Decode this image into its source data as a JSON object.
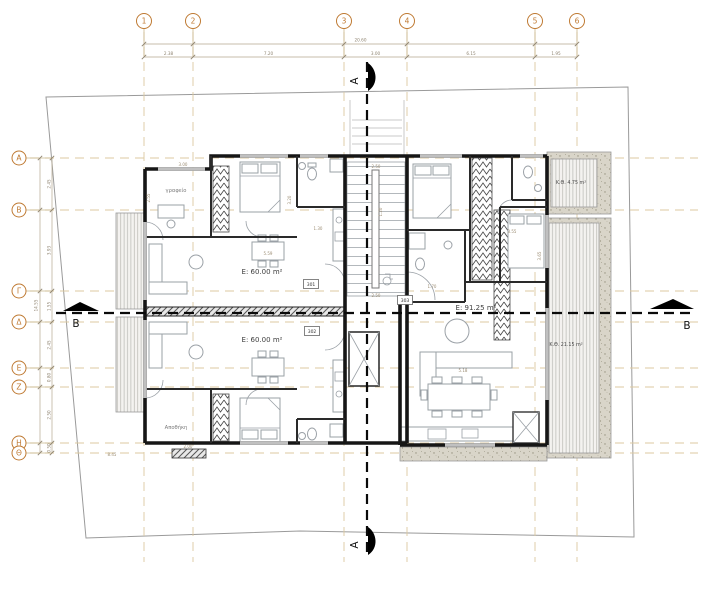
{
  "colors": {
    "grid_dash": "#dcc9a0",
    "bubble_stroke": "#bf7a33",
    "wall": "#161616",
    "dimension": "#8f8471",
    "furniture": "#9aa0a6",
    "section": "#0a0a0a",
    "boundary": "#9a9a9a",
    "deck_hatch": "#b7b7b2",
    "concrete": "#d9d5c9"
  },
  "grid": {
    "columns": [
      {
        "label": "1",
        "x": 144
      },
      {
        "label": "2",
        "x": 193
      },
      {
        "label": "3",
        "x": 344
      },
      {
        "label": "4",
        "x": 407
      },
      {
        "label": "5",
        "x": 535
      },
      {
        "label": "6",
        "x": 577
      }
    ],
    "rows": [
      {
        "label": "A",
        "y": 158
      },
      {
        "label": "B",
        "y": 210
      },
      {
        "label": "Γ",
        "y": 291
      },
      {
        "label": "Δ",
        "y": 322
      },
      {
        "label": "E",
        "y": 368
      },
      {
        "label": "Z",
        "y": 387
      },
      {
        "label": "H",
        "y": 443
      },
      {
        "label": "Θ",
        "y": 453
      }
    ]
  },
  "dimensions": {
    "top_total": "20.60",
    "top_segments": [
      "2.38",
      "7.20",
      "3.00",
      "6.15",
      "1.95"
    ],
    "left_total": "14.55",
    "left_segments": [
      "2.45",
      "3.93",
      "1.55",
      "2.45",
      "0.80",
      "2.50",
      "0.50"
    ],
    "inline": [
      {
        "v": "3.00",
        "x": 183,
        "y": 166,
        "r": 0
      },
      {
        "v": "2.55",
        "x": 150,
        "y": 198,
        "r": -90
      },
      {
        "v": "3.20",
        "x": 291,
        "y": 200,
        "r": -90
      },
      {
        "v": "1.30",
        "x": 318,
        "y": 230,
        "r": 0
      },
      {
        "v": "5.59",
        "x": 268,
        "y": 255,
        "r": 0
      },
      {
        "v": "2.50",
        "x": 376,
        "y": 168,
        "r": 0
      },
      {
        "v": "1.20",
        "x": 382,
        "y": 212,
        "r": -90
      },
      {
        "v": "2.50",
        "x": 376,
        "y": 297,
        "r": 0
      },
      {
        "v": "3.55",
        "x": 512,
        "y": 233,
        "r": 0
      },
      {
        "v": "3.65",
        "x": 541,
        "y": 256,
        "r": -90
      },
      {
        "v": "1.70",
        "x": 432,
        "y": 288,
        "r": 0
      },
      {
        "v": "5.18",
        "x": 463,
        "y": 372,
        "r": 0
      },
      {
        "v": "2.00",
        "x": 188,
        "y": 448,
        "r": 0
      },
      {
        "v": "8.45",
        "x": 112,
        "y": 456,
        "r": 0
      }
    ]
  },
  "sections": {
    "a": {
      "label": "A"
    },
    "b": {
      "label": "B"
    }
  },
  "areas": [
    {
      "label": "E: 60.00 m²",
      "x": 262,
      "y": 274,
      "small": false
    },
    {
      "label": "E: 60.00 m²",
      "x": 262,
      "y": 342,
      "small": false
    },
    {
      "label": "E: 91.25 m²",
      "x": 476,
      "y": 310,
      "small": false
    },
    {
      "label": "Κ.Θ. 4.75 m²",
      "x": 571,
      "y": 184,
      "small": true
    },
    {
      "label": "Κ.Θ. 21.15 m²",
      "x": 566,
      "y": 346,
      "small": true
    }
  ],
  "rooms": [
    {
      "label": "γραφείο",
      "x": 176,
      "y": 192
    },
    {
      "label": "Αποθήκη",
      "x": 176,
      "y": 429
    }
  ],
  "door_tags": [
    {
      "label": "301",
      "x": 311,
      "y": 284
    },
    {
      "label": "302",
      "x": 312,
      "y": 331
    },
    {
      "label": "303",
      "x": 405,
      "y": 300
    }
  ]
}
